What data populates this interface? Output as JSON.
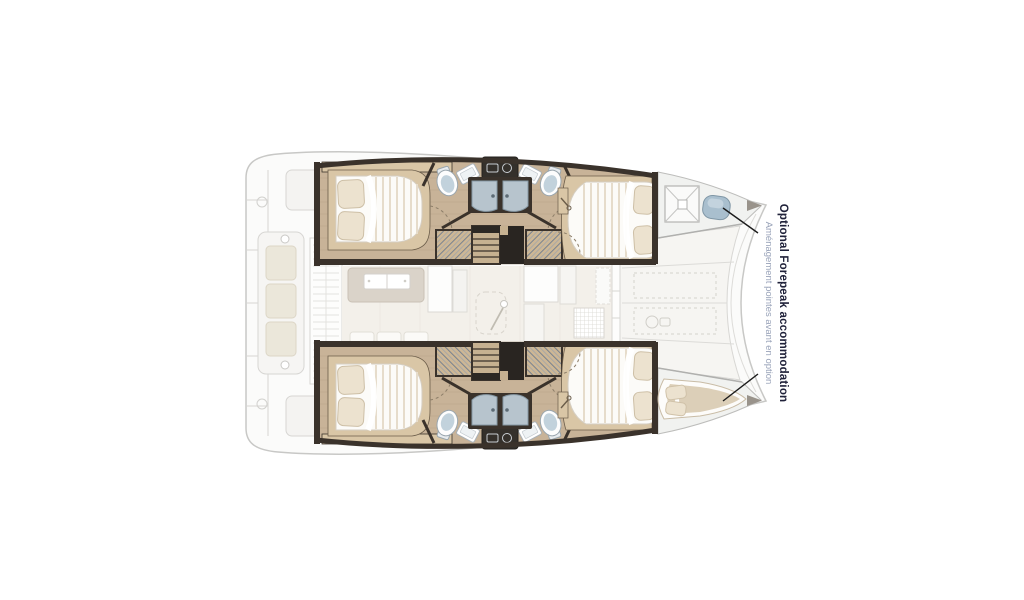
{
  "annotation": {
    "title_en": "Optional Forepeak accommodation",
    "subtitle_fr": "Aménagement pointes avant en option"
  },
  "icons": {
    "bow_hatch": "x-square",
    "windlass": "winch-circle",
    "entry_door": "dashed-door-with-knob"
  },
  "colors": {
    "wood_floor": "#c8b398",
    "wood_trim": "#d9c6a6",
    "wall_dark": "#3a322b",
    "charcoal_block": "#292521",
    "mattress": "#fcfbf8",
    "duvet_stripe": "#e6dccb",
    "pillow": "#ece2cf",
    "shower_panel": "#b7c4cd",
    "forepeak_pad": "#a9bfce",
    "forepeak_berth": "#dccfb8",
    "faded_deck": "#fbfbfa",
    "faded_stroke": "#d7d6d3",
    "leader_line": "#1c1c1c",
    "title_text": "#20223a",
    "subtitle_text": "#98a2b8"
  }
}
